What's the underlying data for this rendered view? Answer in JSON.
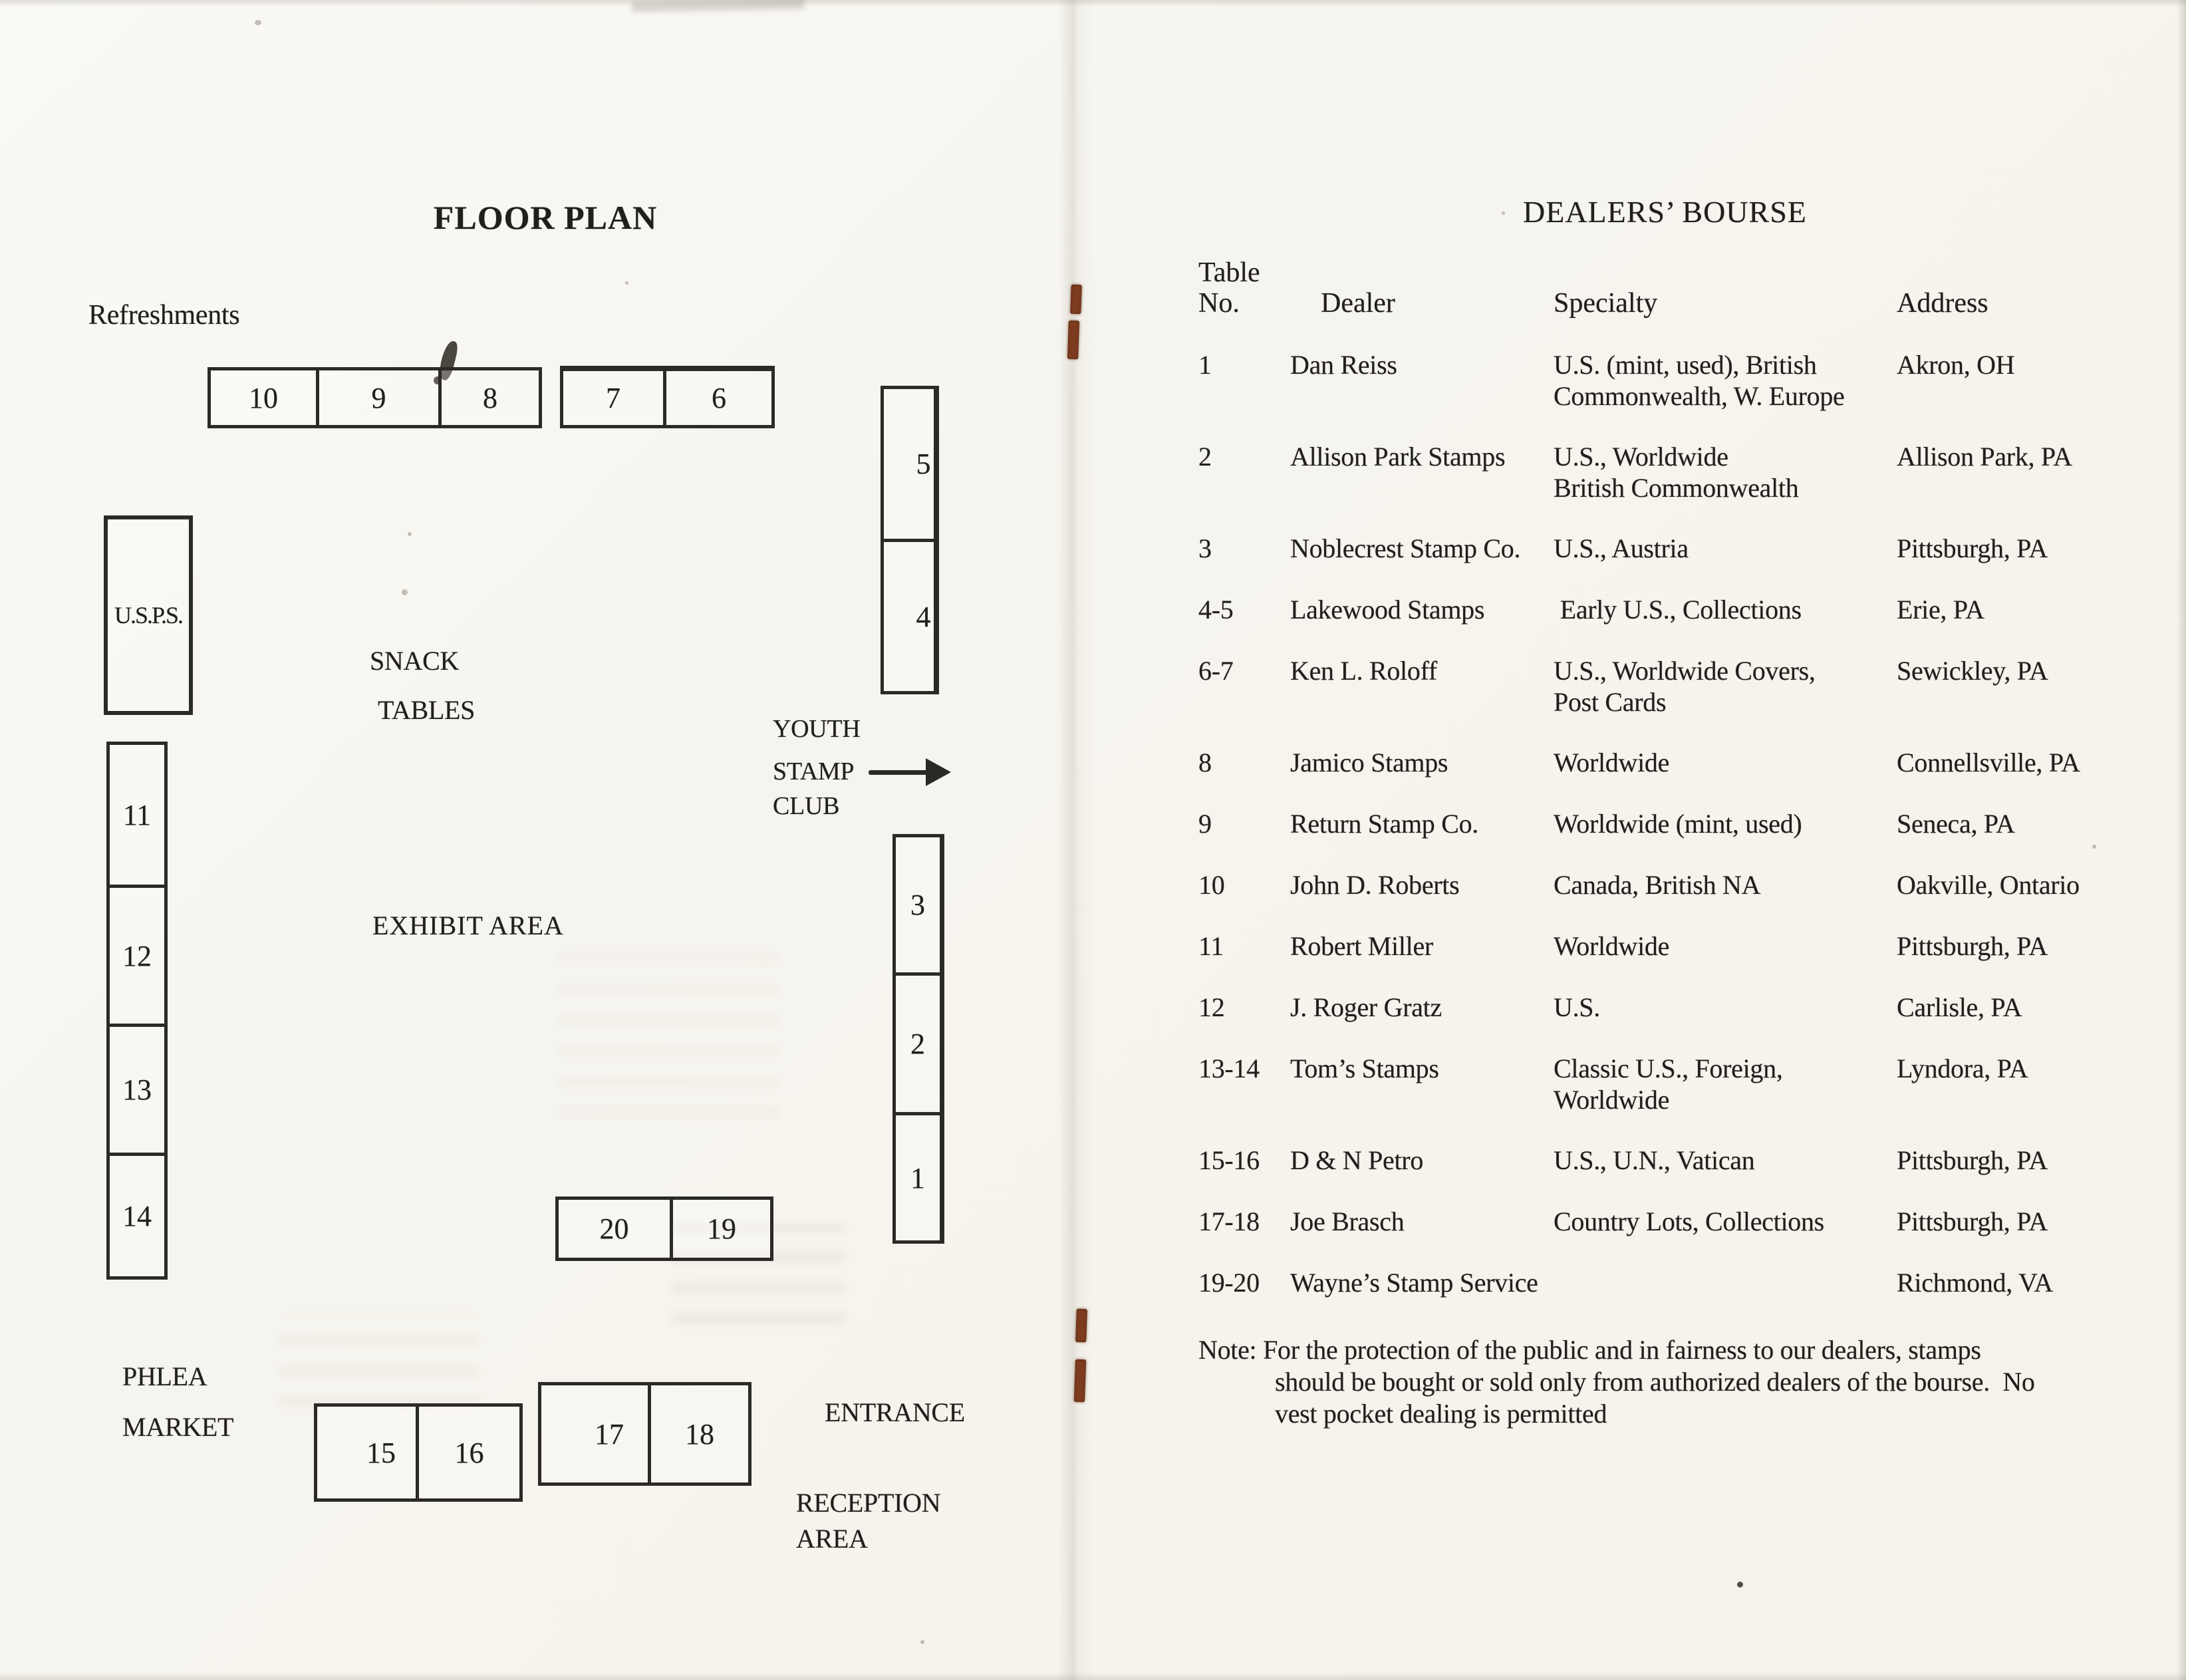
{
  "scan": {
    "left_page": {
      "title": "FLOOR PLAN",
      "refreshments_label": "Refreshments",
      "usps_label": "U.S.P.S.",
      "snack_tables": {
        "line1": "SNACK",
        "line2": "TABLES"
      },
      "youth_stamp_club": {
        "line1": "YOUTH",
        "line2": "STAMP",
        "line3": "CLUB"
      },
      "exhibit_area_label": "EXHIBIT AREA",
      "phlea_market": {
        "line1": "PHLEA",
        "line2": "MARKET"
      },
      "entrance_label": "ENTRANCE",
      "reception_area": {
        "line1": "RECEPTION",
        "line2": "AREA"
      },
      "table_groups": {
        "top_row_a": {
          "cells": [
            "10",
            "9",
            "8"
          ]
        },
        "top_row_b": {
          "cells": [
            "7",
            "6"
          ]
        },
        "right_col_top": {
          "cells": [
            "5",
            "4"
          ]
        },
        "left_col": {
          "cells": [
            "11",
            "12",
            "13",
            "14"
          ]
        },
        "right_col_bottom": {
          "cells": [
            "3",
            "2",
            "1"
          ]
        },
        "center_box": {
          "cells": [
            "20",
            "19"
          ]
        },
        "bottom_row_a": {
          "cells": [
            "15",
            "16"
          ]
        },
        "bottom_row_b": {
          "cells": [
            "17",
            "18"
          ]
        }
      }
    },
    "right_page": {
      "title": "DEALERS’ BOURSE",
      "headers": {
        "table": "Table",
        "no": "No.",
        "dealer": "Dealer",
        "specialty": "Specialty",
        "address": "Address"
      },
      "rows": [
        {
          "no": "1",
          "dealer": "Dan Reiss",
          "spec1": "U.S. (mint, used), British",
          "spec2": "Commonwealth, W. Europe",
          "address": "Akron, OH"
        },
        {
          "no": "2",
          "dealer": "Allison Park Stamps",
          "spec1": "U.S., Worldwide",
          "spec2": "British Commonwealth",
          "address": "Allison Park, PA"
        },
        {
          "no": "3",
          "dealer": "Noblecrest Stamp Co.",
          "spec1": "U.S., Austria",
          "spec2": "",
          "address": "Pittsburgh, PA"
        },
        {
          "no": "4-5",
          "dealer": "Lakewood Stamps",
          "spec1": " Early U.S., Collections",
          "spec2": "",
          "address": "Erie, PA"
        },
        {
          "no": "6-7",
          "dealer": "Ken L. Roloff",
          "spec1": "U.S., Worldwide Covers,",
          "spec2": "Post Cards",
          "address": "Sewickley, PA"
        },
        {
          "no": "8",
          "dealer": "Jamico Stamps",
          "spec1": "Worldwide",
          "spec2": "",
          "address": "Connellsville, PA"
        },
        {
          "no": "9",
          "dealer": "Return Stamp Co.",
          "spec1": "Worldwide (mint, used)",
          "spec2": "",
          "address": "Seneca, PA"
        },
        {
          "no": "10",
          "dealer": "John D. Roberts",
          "spec1": "Canada, British NA",
          "spec2": "",
          "address": "Oakville, Ontario"
        },
        {
          "no": "11",
          "dealer": "Robert Miller",
          "spec1": "Worldwide",
          "spec2": "",
          "address": "Pittsburgh, PA"
        },
        {
          "no": "12",
          "dealer": "J. Roger Gratz",
          "spec1": "U.S.",
          "spec2": "",
          "address": "Carlisle, PA"
        },
        {
          "no": "13-14",
          "dealer": "Tom’s Stamps",
          "spec1": "Classic U.S., Foreign,",
          "spec2": "Worldwide",
          "address": "Lyndora, PA"
        },
        {
          "no": "15-16",
          "dealer": "D & N Petro",
          "spec1": "U.S., U.N., Vatican",
          "spec2": "",
          "address": "Pittsburgh, PA"
        },
        {
          "no": "17-18",
          "dealer": "Joe Brasch",
          "spec1": "Country Lots, Collections",
          "spec2": "",
          "address": "Pittsburgh, PA"
        },
        {
          "no": "19-20",
          "dealer": "Wayne’s Stamp Service",
          "spec1": "",
          "spec2": "",
          "address": "Richmond, VA"
        }
      ],
      "note": {
        "line1": "Note: For the protection of the public and in fairness to our dealers, stamps",
        "line2": "should be bought or sold only from authorized dealers of the bourse.  No",
        "line3": "vest pocket dealing is permitted"
      }
    }
  }
}
